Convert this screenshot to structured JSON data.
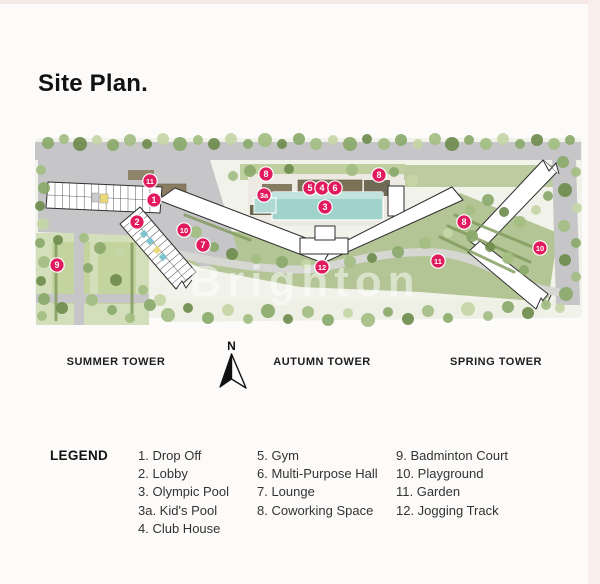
{
  "title": "Site Plan.",
  "map": {
    "watermark": "Brighton",
    "compass": {
      "label": "N"
    },
    "tower_labels": [
      "SUMMER TOWER",
      "AUTUMN TOWER",
      "SPRING TOWER"
    ],
    "marker_color": "#e01a5c",
    "pool_color": "#a0d3cb",
    "markers": [
      {
        "label": "11",
        "x": 150,
        "y": 181
      },
      {
        "label": "1",
        "x": 154,
        "y": 200
      },
      {
        "label": "2",
        "x": 137,
        "y": 222
      },
      {
        "label": "10",
        "x": 184,
        "y": 230
      },
      {
        "label": "7",
        "x": 203,
        "y": 245
      },
      {
        "label": "9",
        "x": 57,
        "y": 265
      },
      {
        "label": "8",
        "x": 266,
        "y": 174
      },
      {
        "label": "3a",
        "x": 264,
        "y": 195
      },
      {
        "label": "5",
        "x": 310,
        "y": 188
      },
      {
        "label": "4",
        "x": 322,
        "y": 188
      },
      {
        "label": "6",
        "x": 335,
        "y": 188
      },
      {
        "label": "3",
        "x": 325,
        "y": 207
      },
      {
        "label": "8",
        "x": 379,
        "y": 175
      },
      {
        "label": "12",
        "x": 322,
        "y": 267
      },
      {
        "label": "8",
        "x": 464,
        "y": 222
      },
      {
        "label": "11",
        "x": 438,
        "y": 261
      },
      {
        "label": "10",
        "x": 540,
        "y": 248
      }
    ]
  },
  "legend": {
    "heading": "LEGEND",
    "columns": [
      {
        "items": [
          "1. Drop Off",
          "2. Lobby",
          "3. Olympic Pool",
          "3a. Kid's Pool",
          "4. Club House"
        ]
      },
      {
        "items": [
          "5. Gym",
          "6. Multi-Purpose Hall",
          "7. Lounge",
          "8. Coworking Space"
        ]
      },
      {
        "items": [
          "9. Badminton Court",
          "10. Playground",
          "11. Garden",
          "12. Jogging Track"
        ]
      }
    ]
  }
}
